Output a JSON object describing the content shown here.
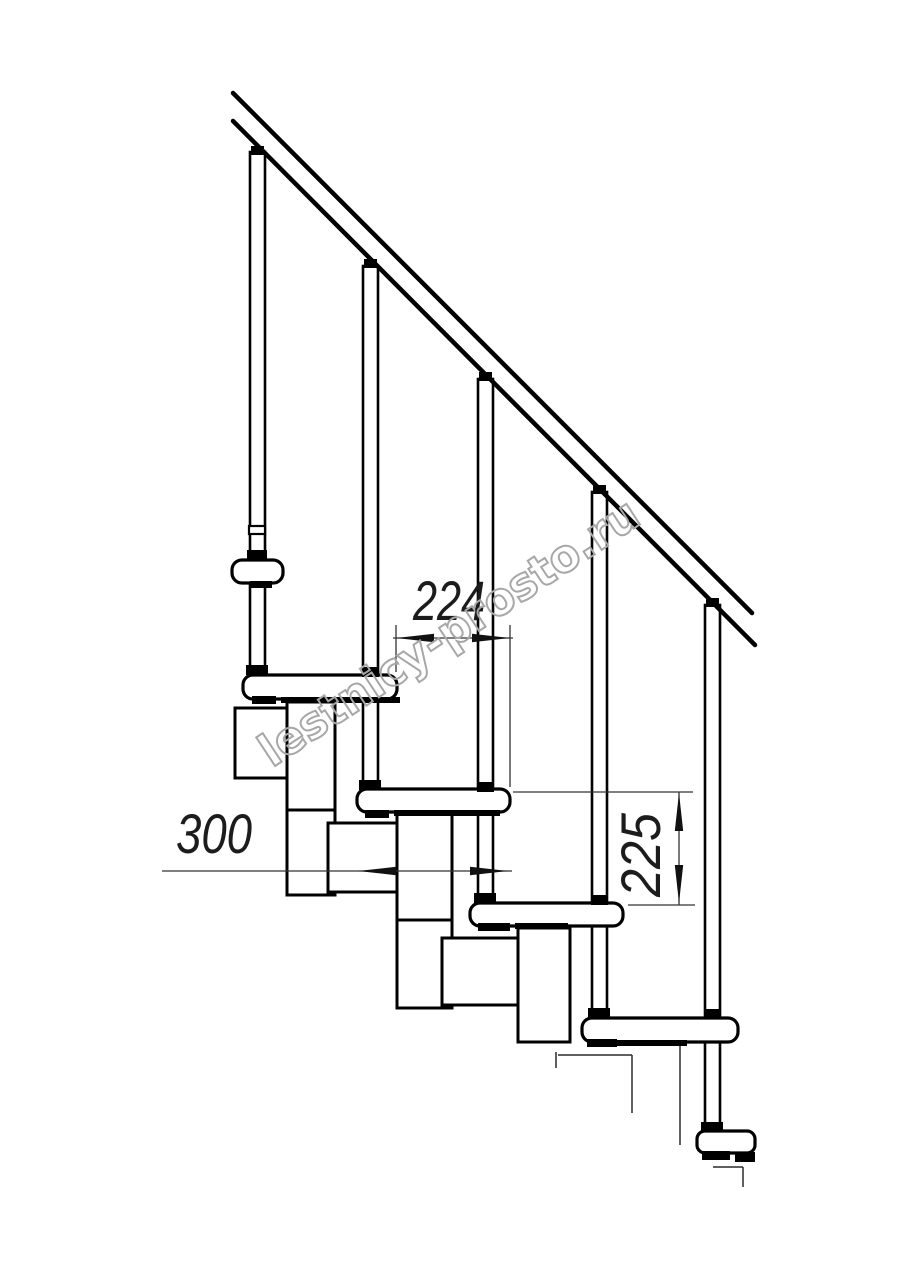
{
  "canvas": {
    "width": 914,
    "height": 1280,
    "background": "#ffffff"
  },
  "colors": {
    "line_main": "#000000",
    "line_thin": "#2a2a2a",
    "line_dim": "#333333",
    "fill_shape": "#ffffff",
    "watermark_stroke": "#a7a7a7"
  },
  "watermark": {
    "text": "lestnicy-prosto.ru",
    "x": 272,
    "y": 768,
    "rotate": -33.5,
    "size": 45,
    "length": 445,
    "stroke_width": 2
  },
  "drawing": {
    "handrail": {
      "stroke_width": 4.5,
      "lines": [
        {
          "x1": 233,
          "y1": 93,
          "x2": 752,
          "y2": 613
        },
        {
          "x1": 233,
          "y1": 121,
          "x2": 755,
          "y2": 645
        }
      ]
    },
    "balusters": [
      {
        "x": 250,
        "y": 152,
        "w": 15,
        "h": 523
      },
      {
        "x": 363,
        "y": 266,
        "w": 15,
        "h": 524
      },
      {
        "x": 478,
        "y": 379,
        "w": 15,
        "h": 524
      },
      {
        "x": 592,
        "y": 492,
        "w": 15,
        "h": 526
      },
      {
        "x": 705,
        "y": 605,
        "w": 15,
        "h": 527
      }
    ],
    "baluster_rings": [
      {
        "x": 249,
        "y": 526,
        "w": 16,
        "h": 8
      }
    ],
    "module_boxes": [
      {
        "x": 235,
        "y": 708,
        "w": 53,
        "h": 70
      },
      {
        "x": 287,
        "y": 702,
        "w": 48,
        "h": 193
      },
      {
        "x": 328,
        "y": 823,
        "w": 75,
        "h": 69
      },
      {
        "x": 397,
        "y": 812,
        "w": 55,
        "h": 196
      },
      {
        "x": 442,
        "y": 938,
        "w": 76,
        "h": 67
      },
      {
        "x": 518,
        "y": 928,
        "w": 52,
        "h": 114
      }
    ],
    "module_inner_lines": [
      {
        "x1": 287,
        "y1": 810,
        "x2": 335,
        "y2": 810
      },
      {
        "x1": 397,
        "y1": 920,
        "x2": 452,
        "y2": 920
      }
    ],
    "treads": [
      {
        "x": 232,
        "y": 560,
        "w": 51,
        "h": 23,
        "r": 10
      },
      {
        "x": 243,
        "y": 675,
        "w": 154,
        "h": 24,
        "r": 10
      },
      {
        "x": 357,
        "y": 789,
        "w": 153,
        "h": 23,
        "r": 10
      },
      {
        "x": 470,
        "y": 903,
        "w": 153,
        "h": 23,
        "r": 10
      },
      {
        "x": 582,
        "y": 1018,
        "w": 156,
        "h": 24,
        "r": 10
      },
      {
        "x": 697,
        "y": 1131,
        "w": 58,
        "h": 22,
        "r": 8
      }
    ],
    "fastener_marks": [
      {
        "x": 251,
        "y": 146,
        "w": 13,
        "h": 9
      },
      {
        "x": 364,
        "y": 259,
        "w": 13,
        "h": 9
      },
      {
        "x": 479,
        "y": 372,
        "w": 13,
        "h": 9
      },
      {
        "x": 593,
        "y": 485,
        "w": 13,
        "h": 9
      },
      {
        "x": 706,
        "y": 598,
        "w": 13,
        "h": 9
      },
      {
        "x": 247,
        "y": 550,
        "w": 20,
        "h": 10
      },
      {
        "x": 246,
        "y": 665,
        "w": 22,
        "h": 10
      },
      {
        "x": 362,
        "y": 667,
        "w": 17,
        "h": 10
      },
      {
        "x": 359,
        "y": 780,
        "w": 22,
        "h": 10
      },
      {
        "x": 477,
        "y": 782,
        "w": 17,
        "h": 10
      },
      {
        "x": 474,
        "y": 893,
        "w": 22,
        "h": 10
      },
      {
        "x": 591,
        "y": 895,
        "w": 17,
        "h": 10
      },
      {
        "x": 588,
        "y": 1008,
        "w": 22,
        "h": 10
      },
      {
        "x": 704,
        "y": 1009,
        "w": 17,
        "h": 9
      },
      {
        "x": 701,
        "y": 1122,
        "w": 22,
        "h": 10
      },
      {
        "x": 250,
        "y": 581,
        "w": 22,
        "h": 7
      },
      {
        "x": 252,
        "y": 696,
        "w": 24,
        "h": 8
      },
      {
        "x": 365,
        "y": 810,
        "w": 24,
        "h": 8
      },
      {
        "x": 478,
        "y": 923,
        "w": 32,
        "h": 8
      },
      {
        "x": 587,
        "y": 1039,
        "w": 30,
        "h": 8
      },
      {
        "x": 702,
        "y": 1151,
        "w": 28,
        "h": 9
      },
      {
        "x": 281,
        "y": 697,
        "w": 119,
        "h": 6
      },
      {
        "x": 394,
        "y": 810,
        "w": 106,
        "h": 6
      },
      {
        "x": 515,
        "y": 923,
        "w": 53,
        "h": 6
      },
      {
        "x": 617,
        "y": 1040,
        "w": 70,
        "h": 6
      },
      {
        "x": 735,
        "y": 1152,
        "w": 20,
        "h": 10
      }
    ],
    "hidden_edges": [
      {
        "x1": 680,
        "y1": 1046,
        "x2": 680,
        "y2": 1145
      },
      {
        "x1": 558,
        "y1": 1055,
        "x2": 632,
        "y2": 1055
      },
      {
        "x1": 632,
        "y1": 1055,
        "x2": 632,
        "y2": 1113
      },
      {
        "x1": 556,
        "y1": 1052,
        "x2": 556,
        "y2": 1068
      },
      {
        "x1": 713,
        "y1": 1167,
        "x2": 743,
        "y2": 1167
      },
      {
        "x1": 743,
        "y1": 1167,
        "x2": 743,
        "y2": 1187
      }
    ],
    "dimensions": {
      "lines": [
        {
          "x1": 396,
          "y1": 625,
          "x2": 396,
          "y2": 672
        },
        {
          "x1": 510,
          "y1": 625,
          "x2": 510,
          "y2": 787
        },
        {
          "x1": 393,
          "y1": 638,
          "x2": 513,
          "y2": 638
        },
        {
          "x1": 162,
          "y1": 871,
          "x2": 512,
          "y2": 871
        },
        {
          "x1": 513,
          "y1": 792,
          "x2": 693,
          "y2": 792
        },
        {
          "x1": 628,
          "y1": 905,
          "x2": 695,
          "y2": 905
        },
        {
          "x1": 679,
          "y1": 792,
          "x2": 679,
          "y2": 905
        }
      ],
      "arrows": [
        {
          "points": "396,638 434,633.8 434,642.2"
        },
        {
          "points": "510,638 472,633.8 472,642.2"
        },
        {
          "points": "358,871 396,866.8 396,875.2"
        },
        {
          "points": "508,871 470,866.8 470,875.2"
        },
        {
          "points": "679,793 674.8,831 683.2,831"
        },
        {
          "points": "679,903 674.8,865 683.2,865"
        }
      ],
      "labels": [
        {
          "text": "224",
          "x": 449,
          "y": 620,
          "rotate": 0,
          "size": 56,
          "length": 72
        },
        {
          "text": "300",
          "x": 214,
          "y": 853,
          "rotate": 0,
          "size": 56,
          "length": 76
        },
        {
          "text": "225",
          "x": 660,
          "y": 855,
          "rotate": -90,
          "size": 56,
          "length": 84
        }
      ]
    }
  }
}
